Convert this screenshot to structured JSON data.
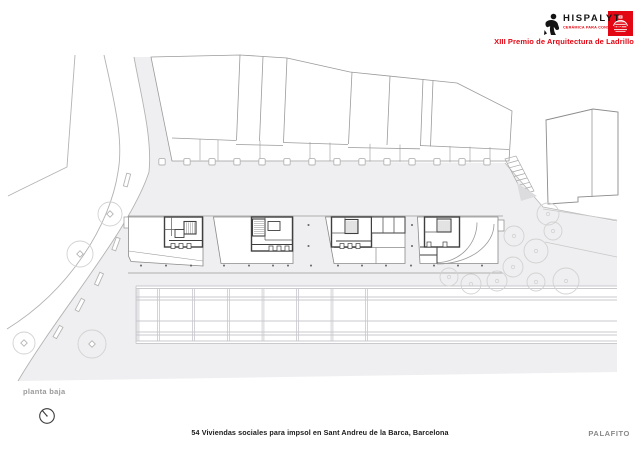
{
  "header": {
    "brand": "HISPALYT",
    "brand_tagline": "CERÁMICA PARA CONSTRUIR",
    "award": "XIII Premio de Arquitectura de Ladrillo"
  },
  "plan": {
    "label": "planta baja"
  },
  "footer": {
    "project_title": "54 Viviendas sociales para impsol en Sant Andreu de la Barca, Barcelona",
    "studio": "PALAFITO"
  },
  "icons": {
    "logo": "hispalyt-figure-icon",
    "badge": "brick-kiln-icon",
    "compass": "north-arrow-icon"
  },
  "colors": {
    "accent_red": "#e30613",
    "plaza_fill": "#efeff1",
    "context_stroke": "#9b9b9b",
    "road_stroke": "#b3b3b3",
    "wall_stroke": "#3f3f3f",
    "grid_stroke": "#c9c9ce",
    "tree_stroke": "#d2d2d2",
    "text_gray": "#8a8a8a"
  }
}
